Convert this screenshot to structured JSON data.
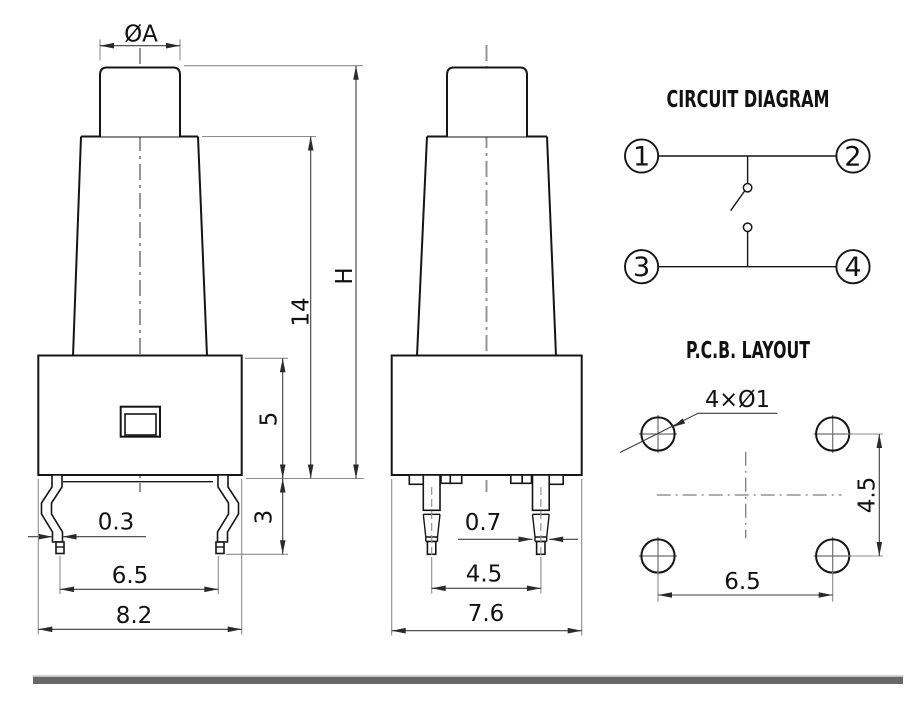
{
  "front_view": {
    "dia_label": "ØA",
    "dim_total_height": "H",
    "dim_cone_height": "14",
    "dim_body_height": "5",
    "dim_pin_length": "3",
    "dim_pin_width": "0.3",
    "dim_pin_spacing": "6.5",
    "dim_body_width": "8.2"
  },
  "side_view": {
    "dim_pin_width": "0.7",
    "dim_pin_spacing": "4.5",
    "dim_body_depth": "7.6"
  },
  "circuit_diagram": {
    "title": "CIRCUIT DIAGRAM",
    "terminals": [
      "1",
      "2",
      "3",
      "4"
    ]
  },
  "pcb_layout": {
    "title": "P.C.B. LAYOUT",
    "holes_label": "4×Ø1",
    "dim_vertical": "4.5",
    "dim_horizontal": "6.5"
  },
  "colors": {
    "outline": "#151515",
    "dimension": "#3d3d3d",
    "centerline": "#909090",
    "footer_bar": "#686868"
  }
}
